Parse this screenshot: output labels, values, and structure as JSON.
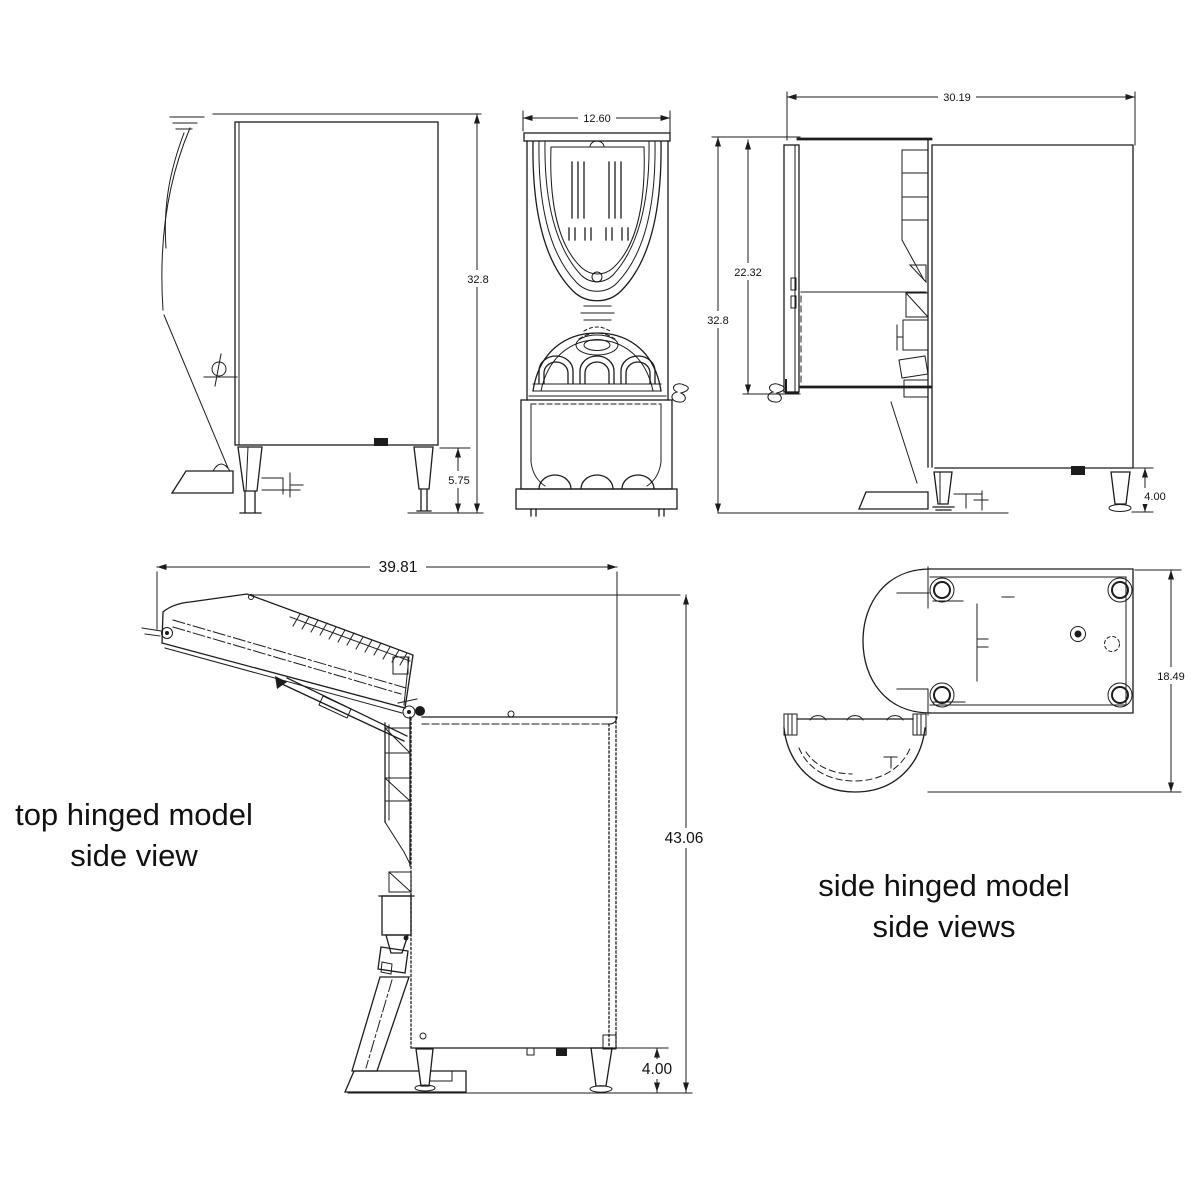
{
  "colors": {
    "line": "#1c1c1c",
    "background": "#ffffff",
    "text": "#111111"
  },
  "views": {
    "side_view_closed": {
      "dim_height": "32.8",
      "dim_leg_height": "5.75"
    },
    "front_view": {
      "dim_width": "12.60"
    },
    "side_view_open_door": {
      "dim_depth": "30.19",
      "dim_door_opening_height": "22.32",
      "dim_height": "32.8",
      "dim_leg_height": "4.00"
    },
    "top_hinged_model": {
      "caption_line1": "top hinged model",
      "caption_line2": "side view",
      "dim_depth_lid_open": "39.81",
      "dim_height_lid_open": "43.06",
      "dim_leg_height": "4.00"
    },
    "side_hinged_model": {
      "caption_line1": "side hinged model",
      "caption_line2": "side views",
      "dim_depth": "18.49"
    }
  }
}
